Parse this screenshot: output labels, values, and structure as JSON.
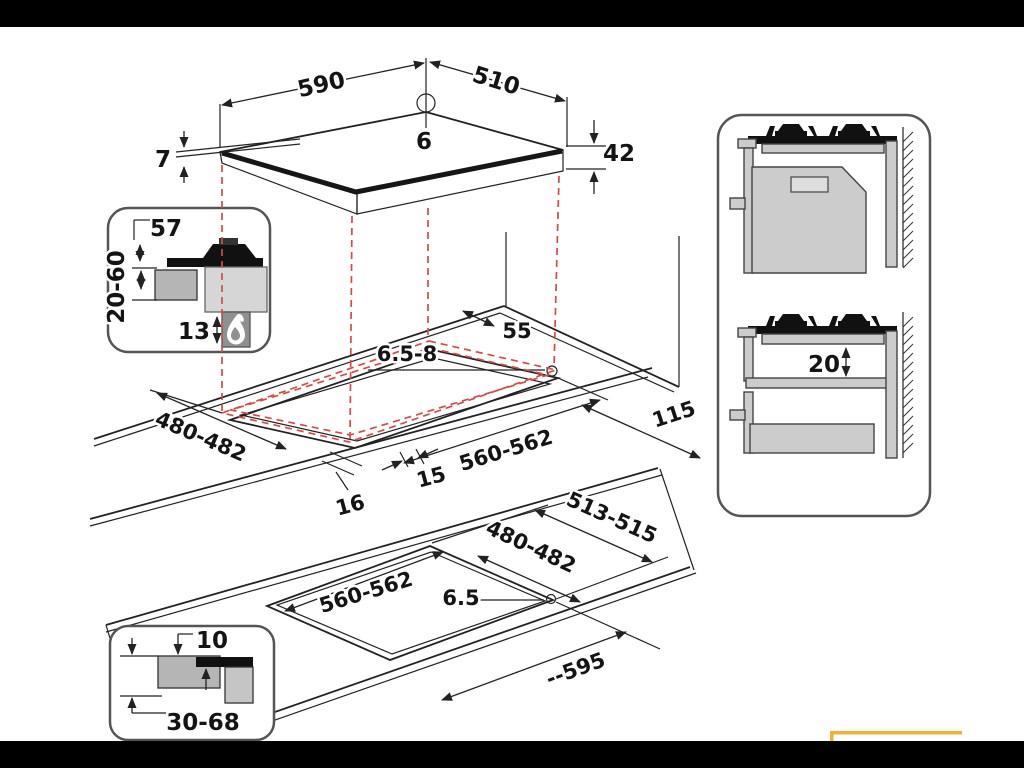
{
  "diagram_title": "gas-hob-installation-dimension-diagram",
  "colors": {
    "line": "#222222",
    "red_projection": "#d94a43",
    "highlight_yellow": "#f2b12e",
    "letterbox": "#000000"
  },
  "icons": {
    "flame": "flame-icon"
  },
  "top_view": {
    "width_mm": "590",
    "depth_mm": "510",
    "hole_diameter_mm": "6",
    "glass_thickness_mm": "7",
    "body_height_mm": "42"
  },
  "left_inset": {
    "burner_height_mm": "57",
    "counter_thickness_mm": "20-60",
    "clearance_below_mm": "13"
  },
  "middle_view": {
    "back_clearance_mm": "55",
    "screw_hole_mm": "6.5-8",
    "side_clearance_mm": "115",
    "cutout_depth_mm": "480-482",
    "cutout_width_mm": "560-562",
    "front_offset_mm": "15",
    "left_offset_mm": "16"
  },
  "right_panel": {
    "shelf_clearance_mm": "20"
  },
  "bottom_view": {
    "outer_depth_mm": "513-515",
    "cutout_depth_mm": "480-482",
    "cutout_width_mm": "560-562",
    "screw_hole_mm": "6.5",
    "overall_width_mm": "--595"
  },
  "bottom_inset": {
    "edge_overlap_mm": "10",
    "counter_range_mm": "30-68"
  }
}
